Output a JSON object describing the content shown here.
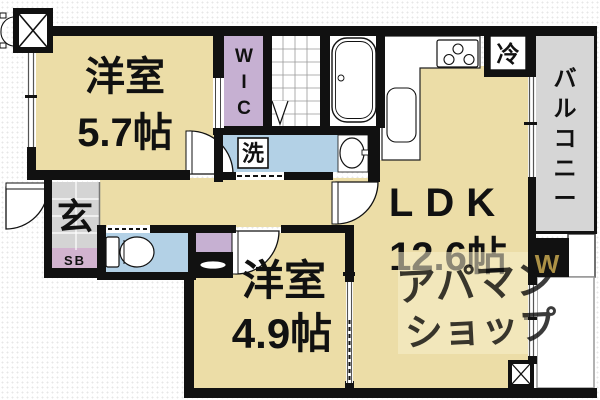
{
  "floorplan": {
    "rooms": {
      "bedroom_a": {
        "name": "洋室",
        "size": "5.7帖"
      },
      "bedroom_b": {
        "name": "洋室",
        "size": "4.9帖"
      },
      "ldk": {
        "name": "LDK",
        "size": "12.6帖"
      },
      "wic": {
        "name": "WIC"
      },
      "balcony": {
        "name": "バルコニー"
      },
      "entrance": {
        "name": "玄"
      },
      "shoe_box": {
        "name": "SB"
      },
      "laundry": {
        "name": "洗"
      },
      "refrigerator": {
        "name": "冷"
      }
    },
    "watermark": {
      "line1": "アパマン",
      "line2": "ショップ",
      "mark": "W"
    },
    "colors": {
      "room_fill": "#ecdda7",
      "closet_fill": "#c6b0d2",
      "sb_fill": "#d2b3cf",
      "wet_fill": "#b3d1e6",
      "entrance_fill": "#d4d4d4",
      "balcony_fill": "#d6d6d6",
      "wall": "#111111",
      "watermark_text": "#d8b74b",
      "watermark_patch": "#f7efcd"
    }
  }
}
